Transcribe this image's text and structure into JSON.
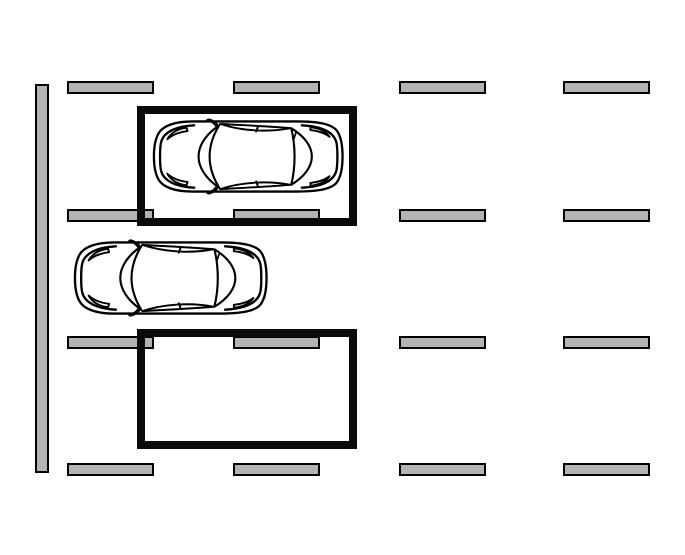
{
  "scene": {
    "type": "parking-lot-top-view",
    "background_color": "#ffffff",
    "curb": {
      "x": 35,
      "y": 84,
      "width": 14,
      "height": 389,
      "fill": "#b3b3b3",
      "stroke": "#000000"
    },
    "lane_markings": {
      "fill": "#b3b3b3",
      "stroke": "#000000",
      "dash_width": 87,
      "dash_height": 13,
      "rows_y": [
        81,
        209,
        336,
        463
      ],
      "cols_x": [
        67,
        233,
        399,
        563
      ]
    },
    "parking_spaces": [
      {
        "label": "occupied-space",
        "x": 137,
        "y": 106,
        "width": 220,
        "height": 120,
        "border_thickness": 8,
        "color": "#0a0a0a",
        "occupied": true
      },
      {
        "label": "empty-space",
        "x": 137,
        "y": 329,
        "width": 220,
        "height": 120,
        "border_thickness": 8,
        "color": "#0a0a0a",
        "occupied": false
      }
    ],
    "cars": [
      {
        "label": "parked-car",
        "x": 152,
        "y": 118,
        "width": 192,
        "height": 77,
        "facing": "left",
        "line_color": "#000000",
        "body_fill": "#ffffff"
      },
      {
        "label": "aisle-car",
        "x": 73,
        "y": 239,
        "width": 195,
        "height": 78,
        "facing": "left",
        "line_color": "#000000",
        "body_fill": "#ffffff"
      }
    ]
  }
}
